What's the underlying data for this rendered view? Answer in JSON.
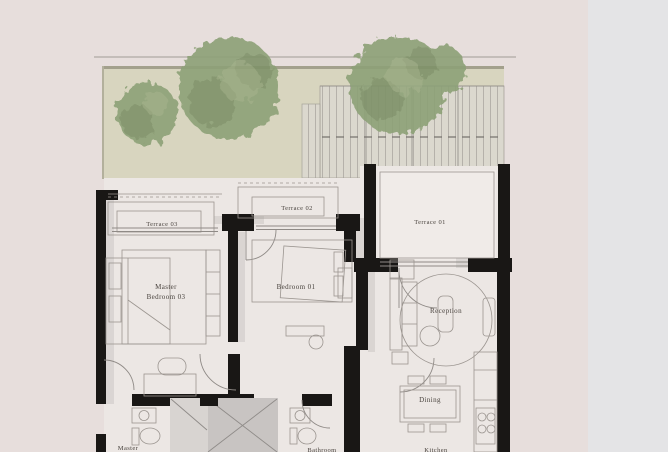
{
  "page": {
    "description": "Architectural floor plan image shown on a webpage",
    "colors": {
      "background_left": "#e7dedc",
      "background_right": "#e4e4e6",
      "wall": "#191715",
      "floor": "#ece7e4",
      "terrace_floor": "#f0ebe8",
      "garden": "#d8d5bf",
      "garden_border": "#a3a08c",
      "pergola": "#dcd9d2",
      "tree": "#8da177",
      "tree_dark": "#74875f",
      "tree_light": "#a4b289",
      "line": "#8f8a86",
      "void_fill": "#c8c4c2",
      "void_light": "#d8d4d1",
      "label": "#4a443f"
    }
  },
  "floor_plan": {
    "labels": {
      "terrace_01": "Terrace 01",
      "terrace_02": "Terrace 02",
      "terrace_03": "Terrace 03",
      "master_bedroom_line1": "Master",
      "master_bedroom_line2": "Bedroom 03",
      "bedroom_01": "Bedroom 01",
      "reception": "Reception",
      "dining": "Dining",
      "master_bathroom": "Master",
      "bathroom": "Bathroom",
      "kitchen": "Kitchen"
    }
  }
}
